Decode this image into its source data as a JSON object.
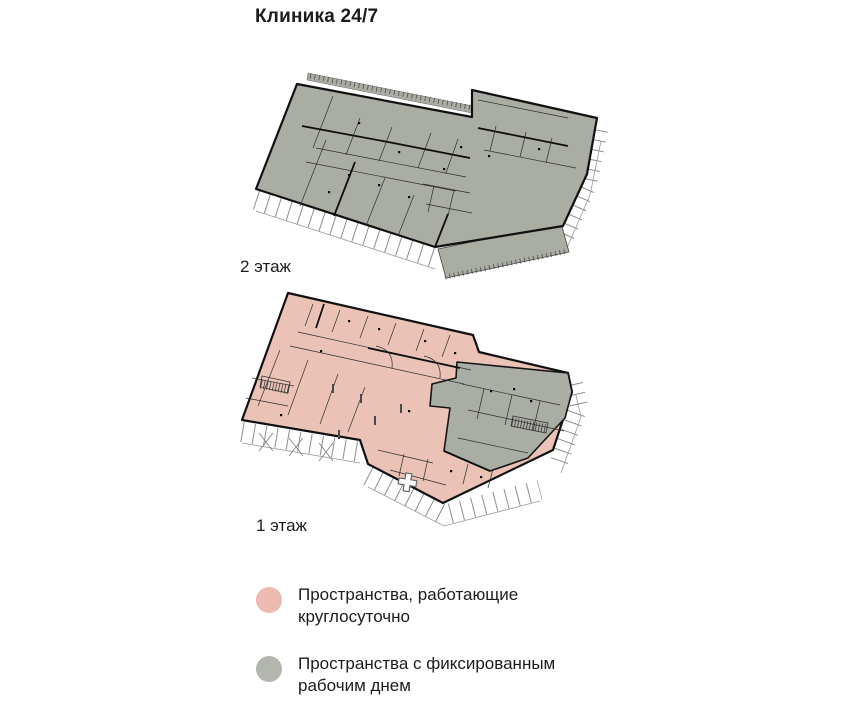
{
  "title": "Клиника 24/7",
  "floors": {
    "second": {
      "label": "2 этаж"
    },
    "first": {
      "label": "1 этаж"
    }
  },
  "legend": {
    "items": [
      {
        "label": "Пространства, работающие круглосуточно",
        "color": "#ecbab0"
      },
      {
        "label": "Пространства с фиксированным рабочим днем",
        "color": "#b3b6af"
      }
    ]
  },
  "colors": {
    "space_24h": "#eac3b6",
    "space_fixed": "#a9ada3",
    "wall": "#111111",
    "background": "#ffffff",
    "cross": "#fcfcfc"
  },
  "icons": {
    "legend_24h_swatch": "circle-swatch-icon",
    "legend_fixed_swatch": "circle-swatch-icon",
    "entrance": "medical-cross-icon"
  }
}
